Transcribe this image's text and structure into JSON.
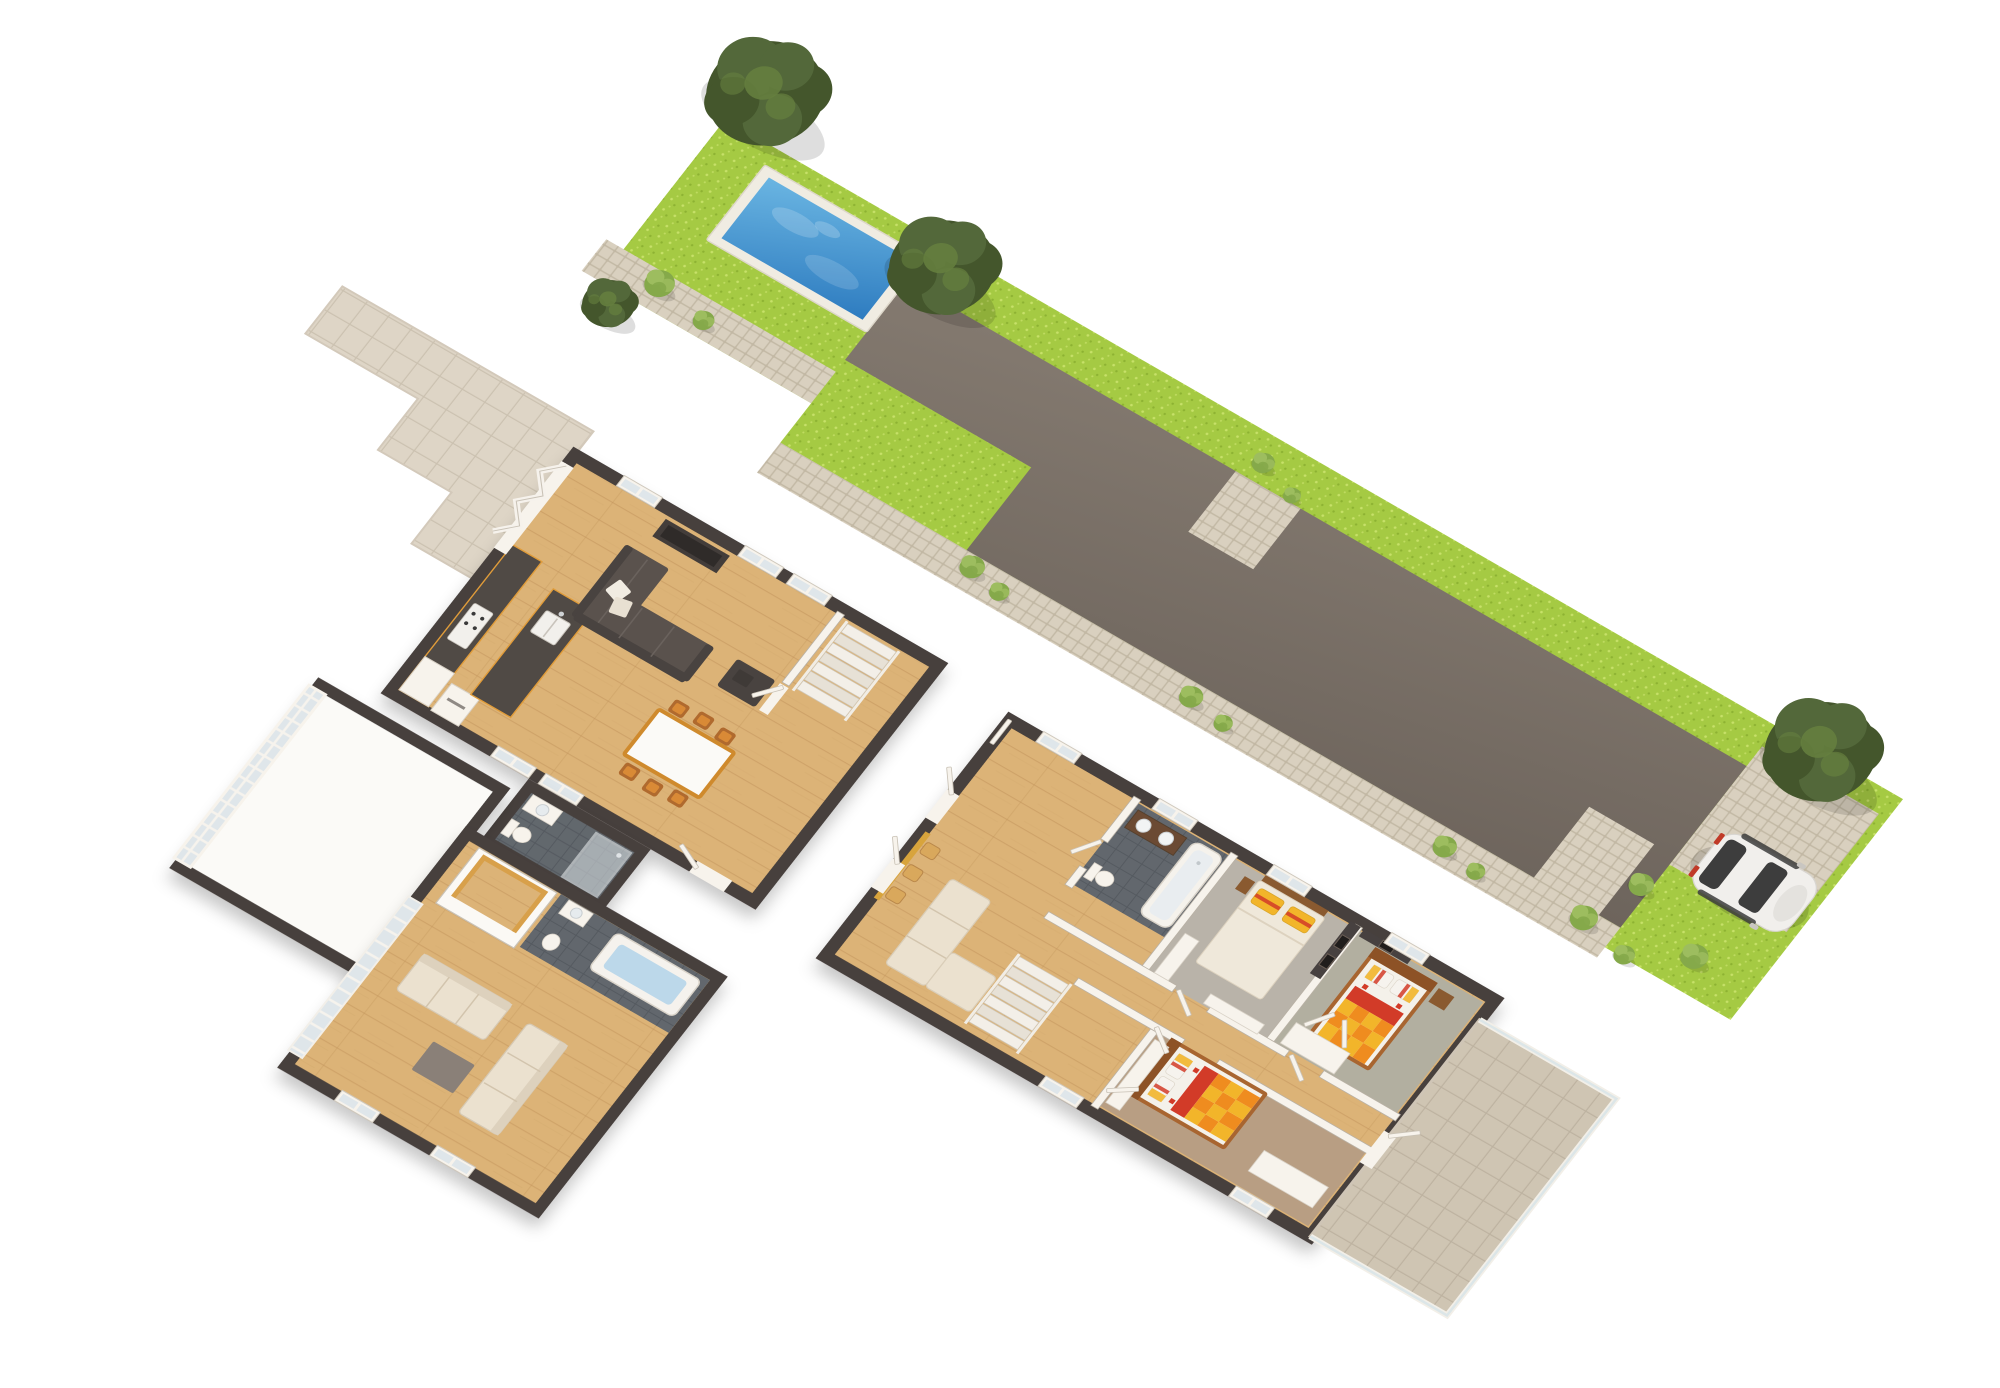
{
  "palette": {
    "grass": "#a5ca43",
    "grass-light": "#c7e169",
    "grass-dark": "#8db232",
    "cobble": "#c2b8a4",
    "cobble-light": "#d9d0bf",
    "pool-deck": "#f0ece2",
    "water-1": "#6ab5e2",
    "water-2": "#2e7cc0",
    "drive-1": "#847a70",
    "drive-2": "#6d645c",
    "wall-dark": "#473f3c",
    "wall-light": "#f7f3ec",
    "wood": "#dcb377",
    "wood-line": "#c2945a",
    "tile-dark": "#62676d",
    "tile-dark-line": "#555a60",
    "patio": "#ded5c6",
    "patio-line": "#cbc1b0",
    "terrace": "#cfc5b3",
    "terrace-line": "#bdb2a0",
    "sofa": "#5a524d",
    "sofa-dark": "#494340",
    "cream": "#ebe1cf",
    "carpet-gray": "#b9b3a9",
    "carpet-green": "#b2afa0",
    "carpet-brown": "#b89e83",
    "counter": "#504a45",
    "counter-edge": "#e09c3a",
    "table-wood": "#cf8a2d",
    "chair": "#b06a2e",
    "chair-seat": "#d98a36",
    "bed-wood": "#a86530",
    "duvet-red": "#d23b28",
    "duvet-orange": "#ef8c1f",
    "duvet-yellow": "#f2b52a",
    "car-body": "#f1efec",
    "car-glass": "#3d3d3d",
    "car-tail": "#c03a28",
    "tree-dark": "#44562c",
    "tree-mid": "#53683a",
    "tree-light": "#66803f",
    "bush": "#85a94a",
    "bush-light": "#9dbd5f",
    "glass": "#dfe6ea",
    "accent-gold": "#d8a43c"
  },
  "scene": {
    "type": "3d-floor-plan-render",
    "view": "isometric-top-down",
    "background": "#ffffff",
    "garden": {
      "lawn": "long-grass-strip",
      "pool": {
        "water": "blue",
        "deck": "white-stone"
      },
      "driveway": "dark-asphalt",
      "footpaths": "cobblestone",
      "parking_pad": "cobblestone",
      "car": {
        "body": "white",
        "glass": "dark",
        "taillight": "red"
      },
      "trees_large": 3,
      "shrubs": 16
    },
    "ground_floor": {
      "patio": "stepped-stone-tiles",
      "rooms": [
        {
          "name": "living-room",
          "floor": "oak",
          "furniture": [
            "corner-sofa",
            "white-pillows",
            "ottoman",
            "media-wall",
            "bifold-patio-doors",
            "windows"
          ]
        },
        {
          "name": "kitchen",
          "floor": "oak",
          "furniture": [
            "wall-counter",
            "island-with-sink",
            "cooktop",
            "fridge",
            "tall-cabinets"
          ]
        },
        {
          "name": "dining-area",
          "floor": "oak",
          "furniture": [
            "table",
            "chairs-x6"
          ]
        },
        {
          "name": "entrance-hall",
          "floor": "oak",
          "furniture": [
            "steps",
            "open-door"
          ]
        },
        {
          "name": "shower-room",
          "floor": "dark-tile",
          "furniture": [
            "walk-in-shower",
            "basin",
            "wc"
          ]
        },
        {
          "name": "garage",
          "floor": "screed",
          "furniture": [
            "glazed-folding-wall"
          ]
        },
        {
          "name": "guest-suite",
          "floor": "oak",
          "furniture": [
            "bathtub",
            "basin",
            "wc",
            "walk-in-wardrobe",
            "cream-sofa-x2",
            "coffee-table",
            "window-wall"
          ]
        }
      ]
    },
    "first_floor": {
      "rooms": [
        {
          "name": "landing-hall",
          "floor": "oak",
          "furniture": [
            "bench-stools-x3",
            "gold-wall-strip",
            "cream-daybed",
            "open-doors"
          ]
        },
        {
          "name": "bathroom",
          "floor": "dark-tile",
          "furniture": [
            "double-vanity",
            "bathtub",
            "wc"
          ]
        },
        {
          "name": "master-bedroom",
          "floor": "carpet",
          "furniture": [
            "double-bed-cream",
            "yellow-pillows",
            "nightstand",
            "dresser",
            "wall-art-x2"
          ]
        },
        {
          "name": "bedroom-2",
          "floor": "carpet",
          "furniture": [
            "double-bed-checker",
            "nightstand",
            "wardrobe-open",
            "wall-art"
          ]
        },
        {
          "name": "bedroom-3",
          "floor": "carpet",
          "furniture": [
            "double-bed-checker",
            "wardrobe-open",
            "desk"
          ]
        },
        {
          "name": "staircase",
          "floor": "oak",
          "furniture": [
            "stairs",
            "railings"
          ]
        },
        {
          "name": "terrace",
          "floor": "stone-tiles",
          "furniture": [
            "glass-railing"
          ]
        }
      ]
    }
  }
}
